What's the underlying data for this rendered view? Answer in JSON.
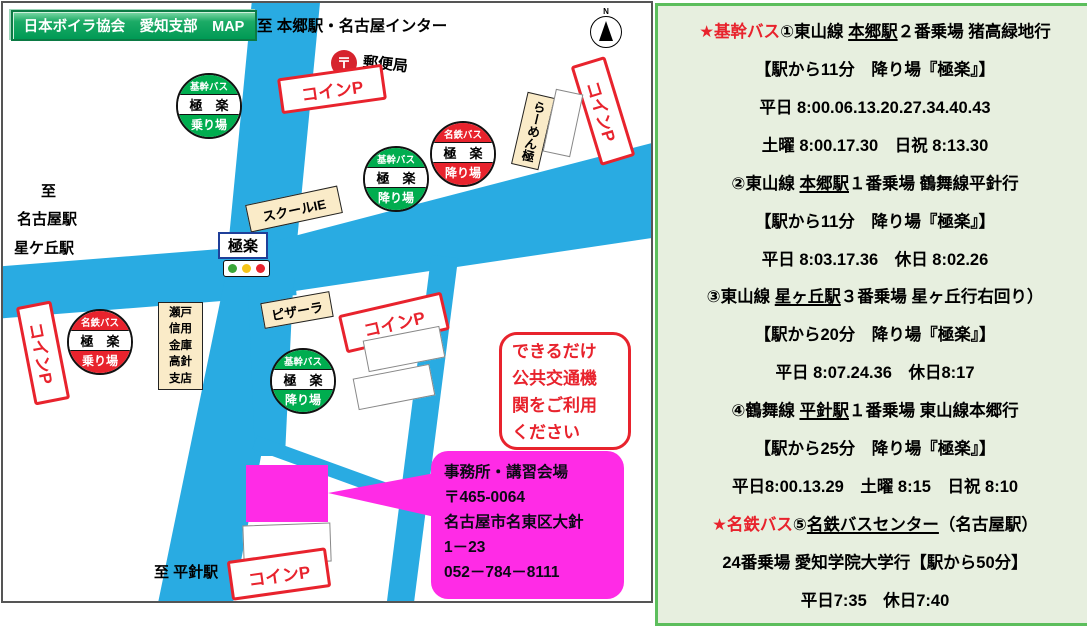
{
  "colors": {
    "road": "#29ABE2",
    "kikan_bus_green": "#00AD4F",
    "meitetsu_bus_red": "#E8232D",
    "office_magenta": "#FF2BE6",
    "panel_border_green": "#5CBE5C",
    "panel_bg_green": "#E7EFDF",
    "header_green": "#009A55"
  },
  "map": {
    "title": "日本ボイラ協会　愛知支部　MAP",
    "compass": "N",
    "directions": {
      "top": "至 本郷駅・名古屋インター",
      "left1": "至",
      "left2": "名古屋駅",
      "left3": "星ケ丘駅",
      "bottom": "至 平針駅"
    },
    "post_office": {
      "symbol": "〒",
      "label": "郵便局"
    },
    "intersection": {
      "name": "極楽"
    },
    "coin_parking": "コインP",
    "bus_stops": [
      {
        "operator": "基幹バス",
        "stop": "極　楽",
        "kind": "乗り場",
        "color": "green"
      },
      {
        "operator": "基幹バス",
        "stop": "極　楽",
        "kind": "降り場",
        "color": "green"
      },
      {
        "operator": "名鉄バス",
        "stop": "極　楽",
        "kind": "降り場",
        "color": "red"
      },
      {
        "operator": "名鉄バス",
        "stop": "極　楽",
        "kind": "乗り場",
        "color": "red"
      },
      {
        "operator": "基幹バス",
        "stop": "極　楽",
        "kind": "降り場",
        "color": "green"
      }
    ],
    "landmarks": {
      "school": "スクールIE",
      "ramen": "らーめん極",
      "pizza": "ピザーラ",
      "bank": "瀬戸\n信用\n金庫\n高針\n支店"
    },
    "notice": "できるだけ\n公共交通機\n関をご利用\nください",
    "office": {
      "line1": "事務所・講習会場",
      "line2": "〒465-0064",
      "line3": "名古屋市名東区大針",
      "line4": "1－23",
      "line5": "052－784－8111"
    }
  },
  "panel": {
    "lines": [
      {
        "star": "★基幹バス",
        "pre": "①東山線 ",
        "u": "本郷駅",
        "post": "２番乗場 猪高緑地行"
      },
      {
        "text": "【駅から11分　降り場『極楽』】"
      },
      {
        "text": "平日 8:00.06.13.20.27.34.40.43"
      },
      {
        "text": "土曜 8:00.17.30　日祝 8:13.30"
      },
      {
        "pre": "②東山線 ",
        "u": "本郷駅",
        "post": "１番乗場 鶴舞線平針行"
      },
      {
        "text": "【駅から11分　降り場『極楽』】"
      },
      {
        "text": "平日 8:03.17.36　休日 8:02.26"
      },
      {
        "pre": "③東山線 ",
        "u": "星ヶ丘駅",
        "post": "３番乗場 星ヶ丘行右回り）"
      },
      {
        "text": "【駅から20分　降り場『極楽』】"
      },
      {
        "text": "平日 8:07.24.36　休日8:17"
      },
      {
        "pre": "④鶴舞線 ",
        "u": "平針駅",
        "post": "１番乗場 東山線本郷行"
      },
      {
        "text": "【駅から25分　降り場『極楽』】"
      },
      {
        "text": "平日8:00.13.29　土曜 8:15　日祝 8:10"
      },
      {
        "star": "★名鉄バス",
        "pre": "⑤",
        "u": "名鉄バスセンター",
        "post": "（名古屋駅）"
      },
      {
        "text": "24番乗場 愛知学院大学行【駅から50分】"
      },
      {
        "text": "平日7:35　休日7:40"
      }
    ]
  }
}
